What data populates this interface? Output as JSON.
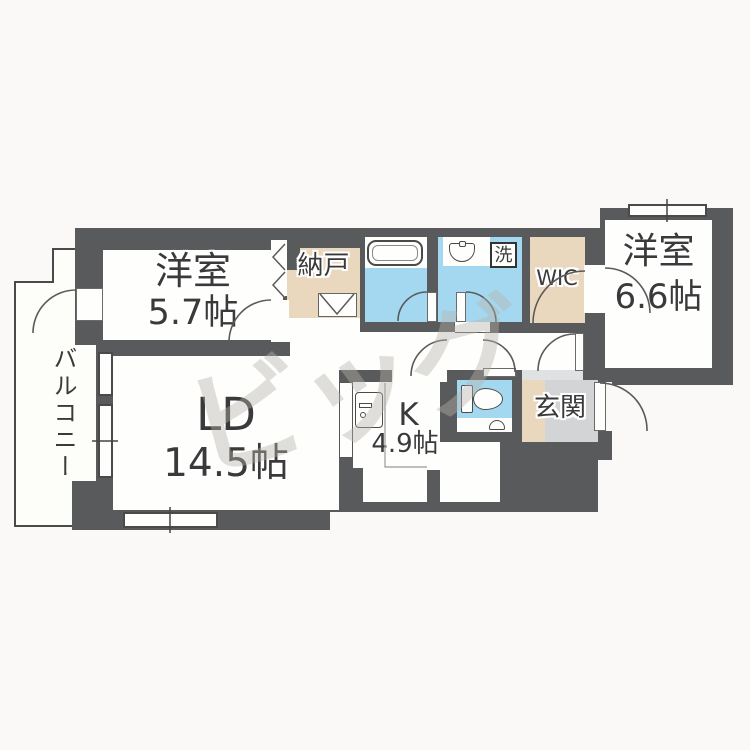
{
  "plan": {
    "watermark": "ビッグ",
    "rooms": {
      "bedroom_west": {
        "name": "洋室",
        "size": "5.7帖"
      },
      "living_dining": {
        "name": "LD",
        "size": "14.5帖"
      },
      "kitchen": {
        "name": "K",
        "size": "4.9帖"
      },
      "bedroom_east": {
        "name": "洋室",
        "size": "6.6帖"
      },
      "storage": {
        "name": "納戸"
      },
      "walk_in_closet": {
        "name": "WIC"
      },
      "entrance": {
        "name": "玄関"
      },
      "balcony": {
        "name": "バルコニー"
      },
      "laundry": {
        "name": "洗"
      }
    },
    "colors": {
      "wall": "#595A5C",
      "wet_area_blue": "#A4D7F0",
      "closet_beige": "#E9D8BE",
      "entrance_tile": "#D3D4D6",
      "background": "#FAF9F7"
    }
  }
}
